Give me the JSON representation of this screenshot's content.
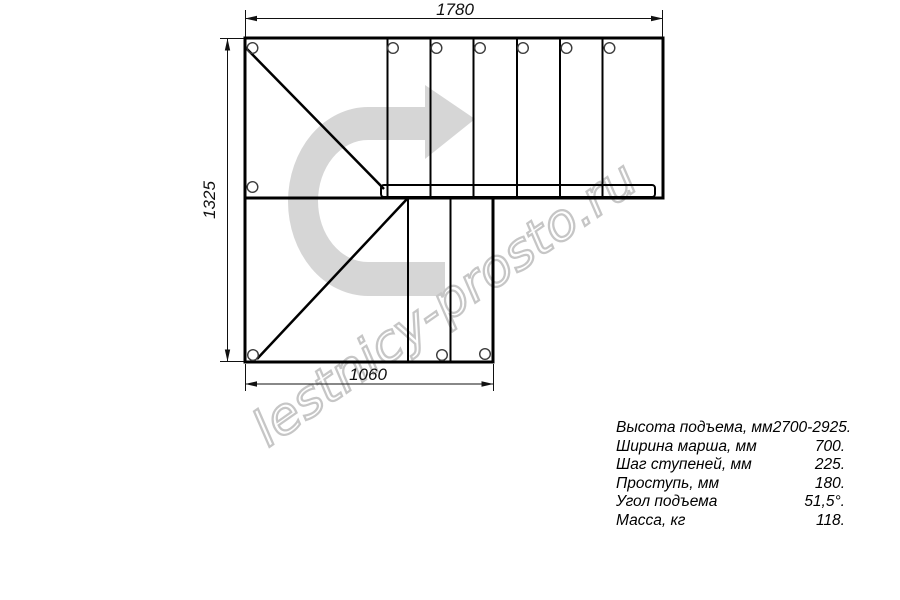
{
  "drawing": {
    "dim_top": "1780",
    "dim_left": "1325",
    "dim_bottom": "1060",
    "watermark": "lestnicy-prosto.ru",
    "arrow_color": "#d6d6d6",
    "watermark_color": "#c6c6c6",
    "line_color": "#000000"
  },
  "specs": {
    "rows": [
      {
        "label": "Высота подъема, мм",
        "value": "2700-2925."
      },
      {
        "label": "Ширина марша, мм",
        "value": "700."
      },
      {
        "label": "Шаг ступеней, мм",
        "value": "225."
      },
      {
        "label": "Проступь, мм",
        "value": "180."
      },
      {
        "label": "Угол подъема",
        "value": "51,5°."
      },
      {
        "label": "Масса, кг",
        "value": "118."
      }
    ]
  }
}
